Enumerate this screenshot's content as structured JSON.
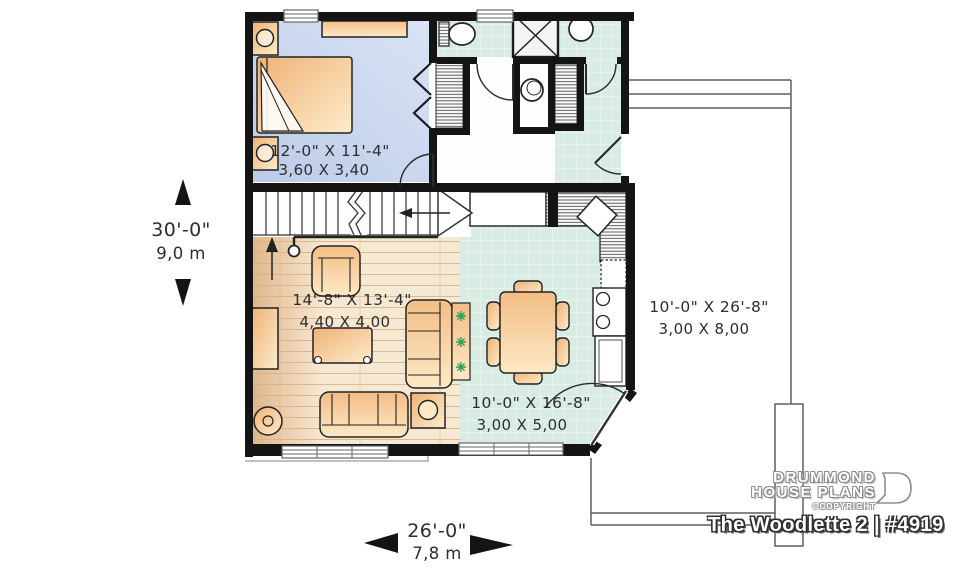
{
  "branding": {
    "name_line1": "DRUMMOND",
    "name_line2": "HOUSE PLANS",
    "copyright": "©COPYRIGHT",
    "plan_title": "The Woodlette 2 | #4919"
  },
  "dimensions": {
    "overall_depth": {
      "imperial": "30'-0\"",
      "metric": "9,0 m"
    },
    "overall_width": {
      "imperial": "26'-0\"",
      "metric": "7,8 m"
    }
  },
  "rooms": {
    "bedroom": {
      "imperial": "12'-0\" X 11'-4\"",
      "metric": "3,60 X 3,40"
    },
    "living": {
      "imperial": "14'-8\" X 13'-4\"",
      "metric": "4,40 X 4,00"
    },
    "kitchen_dining": {
      "imperial": "10'-0\" X 16'-8\"",
      "metric": "3,00 X 5,00"
    },
    "deck": {
      "imperial": "10'-0\" X 26'-8\"",
      "metric": "3,00 X 8,00"
    }
  },
  "colors": {
    "wall": "#141414",
    "bedroom_floor": "#c7d4ec",
    "tile_floor": "#d9ece3",
    "wood_floor": "#f6e9d4",
    "furniture": "#f5c68f",
    "deck_line": "#5f5f5f",
    "dimension_text": "#2e2e2e",
    "plant": "#2da05a",
    "title_text": "#ffffff"
  }
}
